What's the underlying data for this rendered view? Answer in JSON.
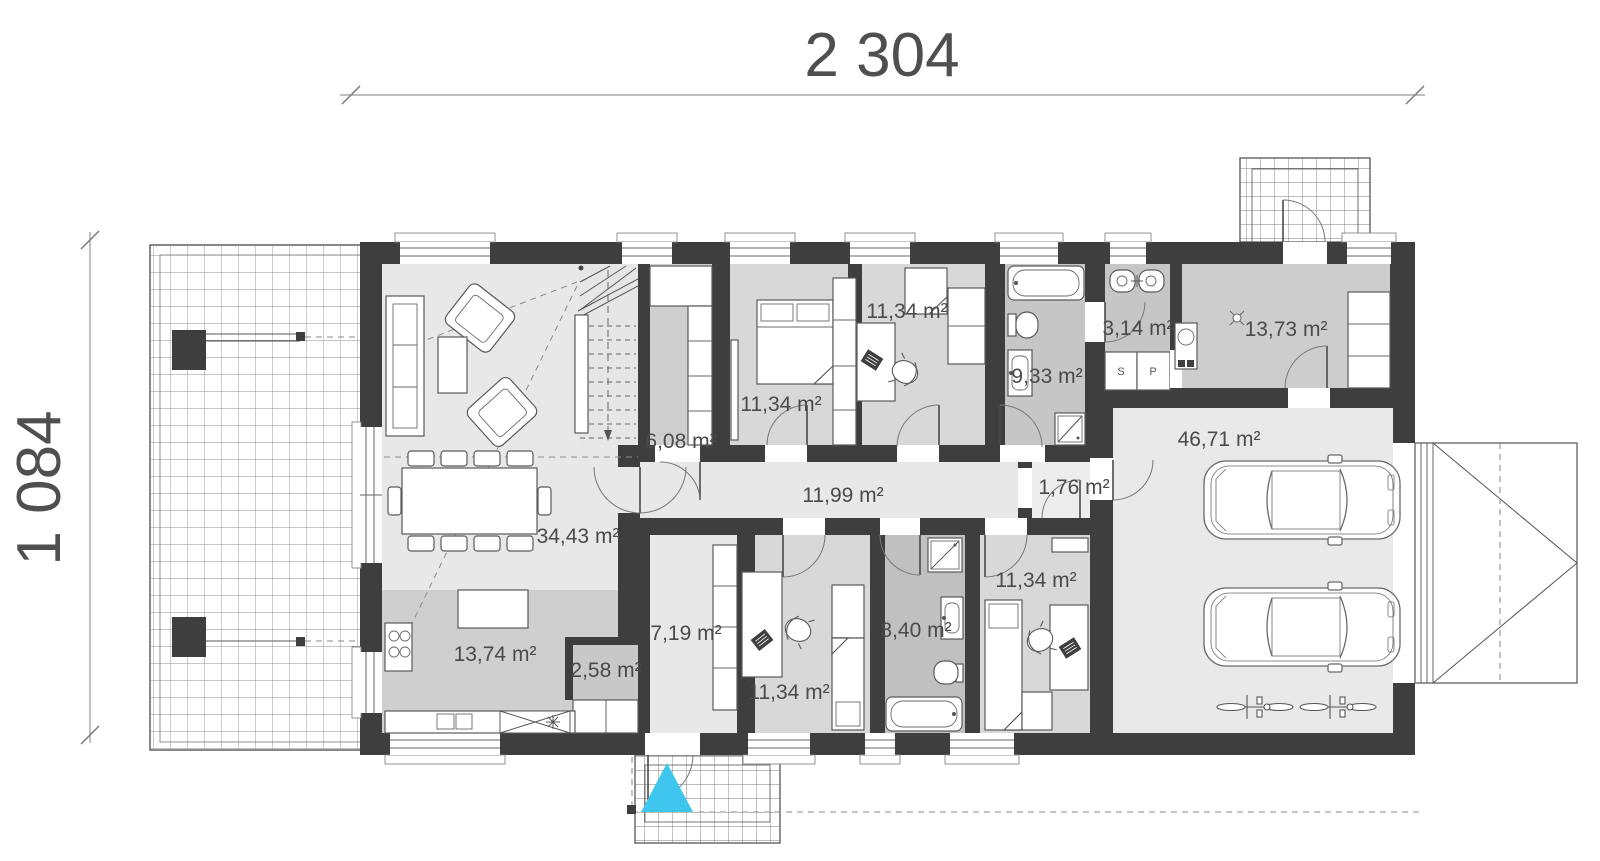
{
  "dimensions": {
    "width_label": "2 304",
    "height_label": "1 084"
  },
  "rooms": {
    "living_dining": "34,43 m²",
    "kitchen": "13,74 m²",
    "pantry": "2,58 m²",
    "wardrobe": "6,08 m²",
    "hallway": "11,99 m²",
    "vestibule": "1,76 m²",
    "corridor": "7,19 m²",
    "bedroom_top_left": "11,34 m²",
    "bedroom_top_middle": "11,34 m²",
    "bathroom_main": "9,33 m²",
    "wc": "3,14 m²",
    "utility": "13,73 m²",
    "bedroom_bottom_left": "11,34 m²",
    "bathroom_small": "8,40 m²",
    "bedroom_bottom_right": "11,34 m²",
    "garage": "46,71 m²"
  },
  "closet_labels": {
    "s": "S",
    "p": "P"
  },
  "colors": {
    "wall": "#3e3e3e",
    "entrance_marker": "#3ec6ee",
    "floor_light": "#e8e8e8",
    "floor_mid": "#d8d8d8",
    "floor_dark": "#c6c6c6"
  }
}
